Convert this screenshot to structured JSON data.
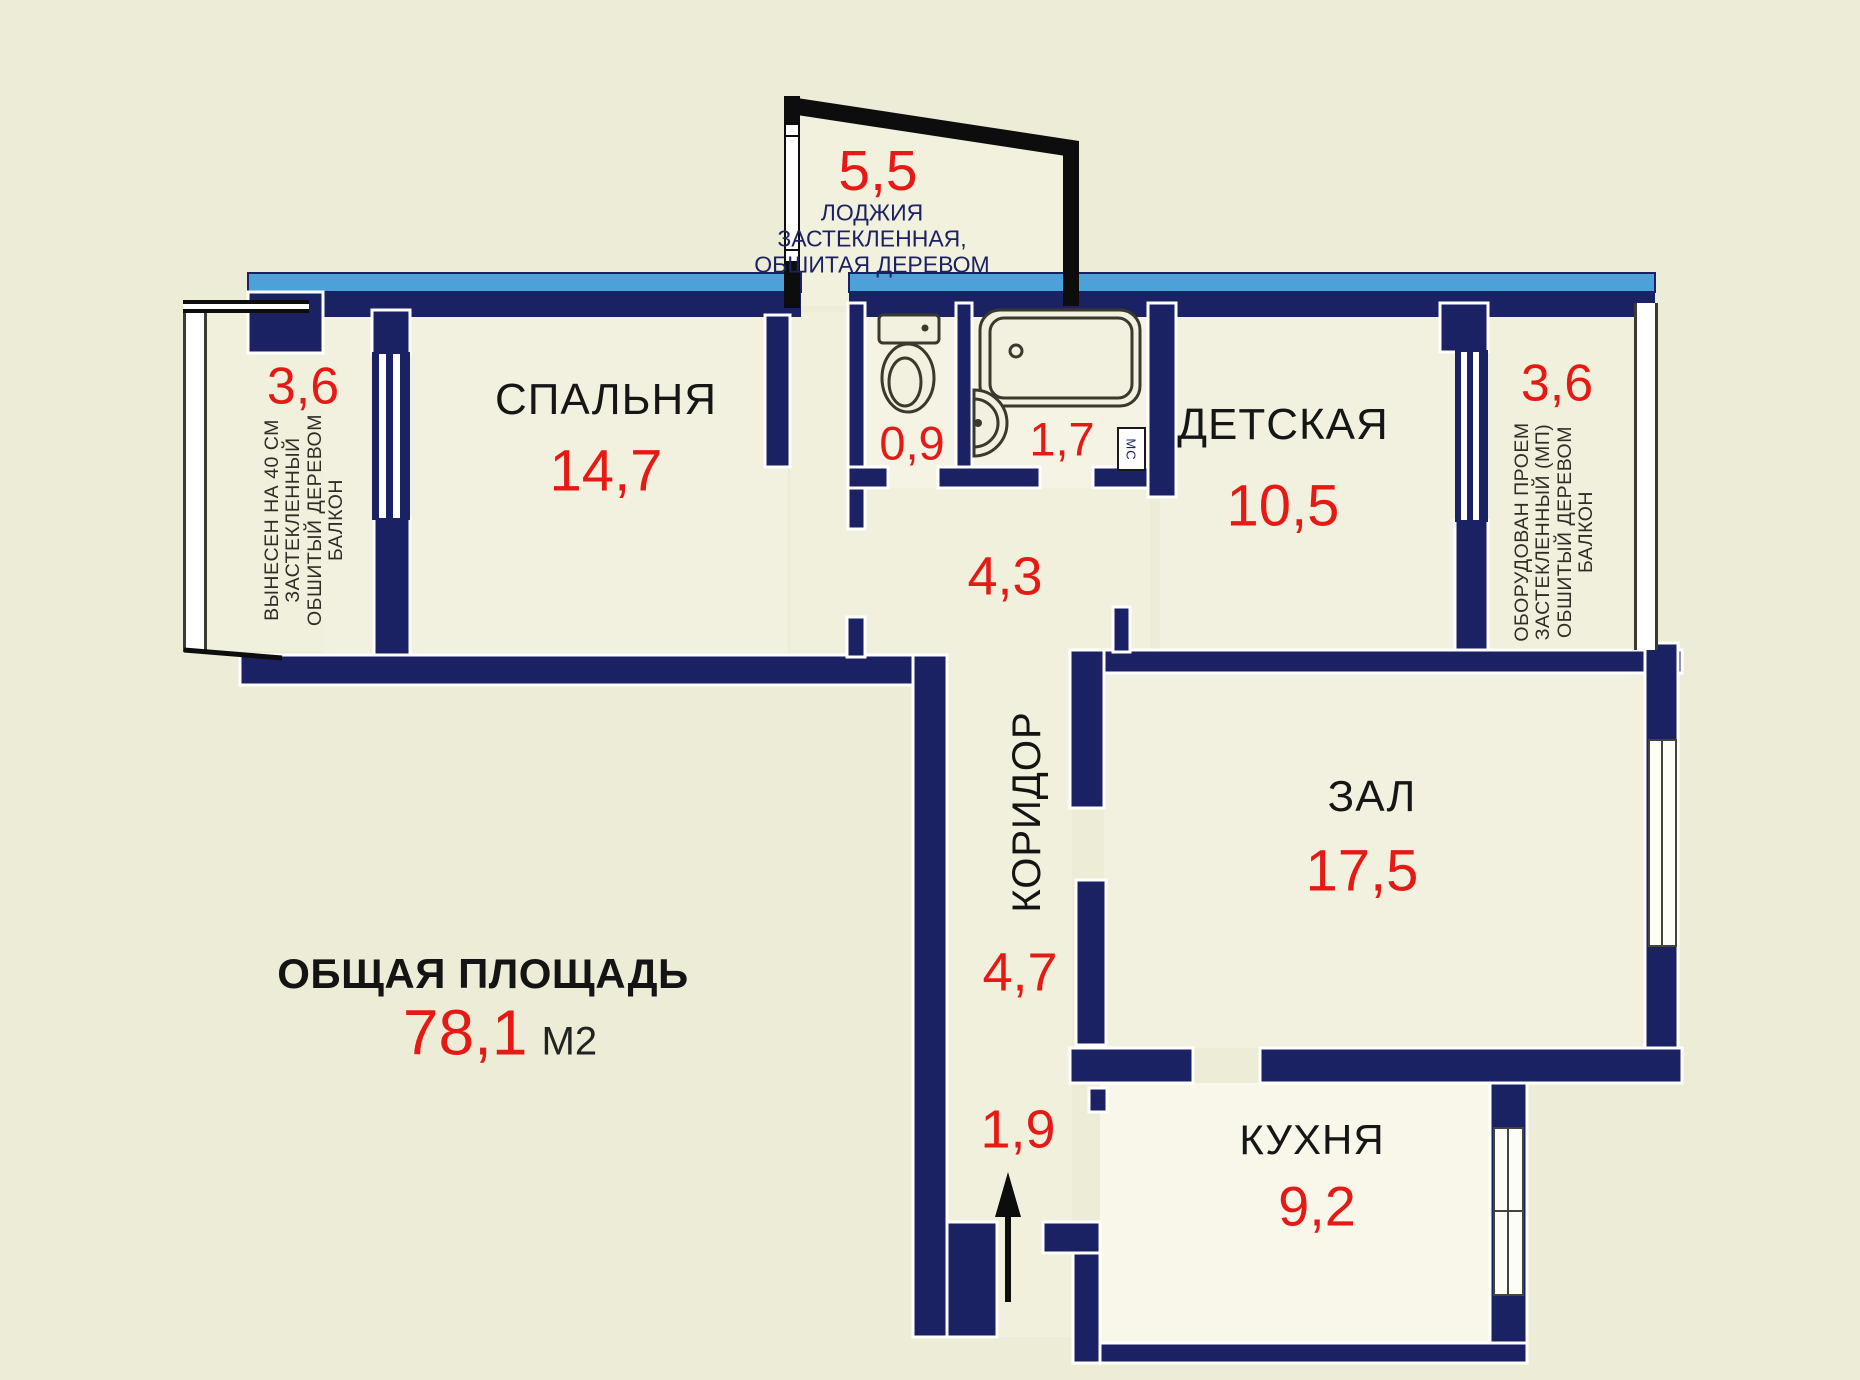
{
  "plan": {
    "total": {
      "label": "ОБЩАЯ ПЛОЩАДЬ",
      "value": "78,1",
      "unit": "М2"
    },
    "bedroom": {
      "name": "СПАЛЬНЯ",
      "area": "14,7"
    },
    "nursery": {
      "name": "ДЕТСКАЯ",
      "area": "10,5"
    },
    "hall": {
      "name": "ЗАЛ",
      "area": "17,5"
    },
    "kitchen": {
      "name": "КУХНЯ",
      "area": "9,2"
    },
    "corridor": {
      "name": "КОРИДОР",
      "area_top": "4,3",
      "area_mid": "4,7",
      "area_entry": "1,9"
    },
    "wc": {
      "area": "0,9"
    },
    "bathroom": {
      "area": "1,7",
      "badge": "МС"
    },
    "loggia": {
      "area": "5,5",
      "line1": "ЛОДЖИЯ",
      "line2": "ЗАСТЕКЛЕННАЯ,",
      "line3": "ОБШИТАЯ ДЕРЕВОМ"
    },
    "balcony_left": {
      "area": "3,6",
      "line1": "ВЫНЕСЕН НА 40 СМ",
      "line2": "ЗАСТЕКЛЕННЫЙ",
      "line3": "ОБШИТЫЙ ДЕРЕВОМ",
      "line4": "БАЛКОН"
    },
    "balcony_right": {
      "area": "3,6",
      "line1": "ОБОРУДОВАН ПРОЕМ",
      "line2": "ЗАСТЕКЛЕННЫЙ (МП)",
      "line3": "ОБШИТЫЙ ДЕРЕВОМ",
      "line4": "БАЛКОН"
    }
  },
  "colors": {
    "wall_navy": "#1b2264",
    "top_wall_blue": "#4ba1d8",
    "accent_red": "#e51a15",
    "background": "#edecd7"
  }
}
